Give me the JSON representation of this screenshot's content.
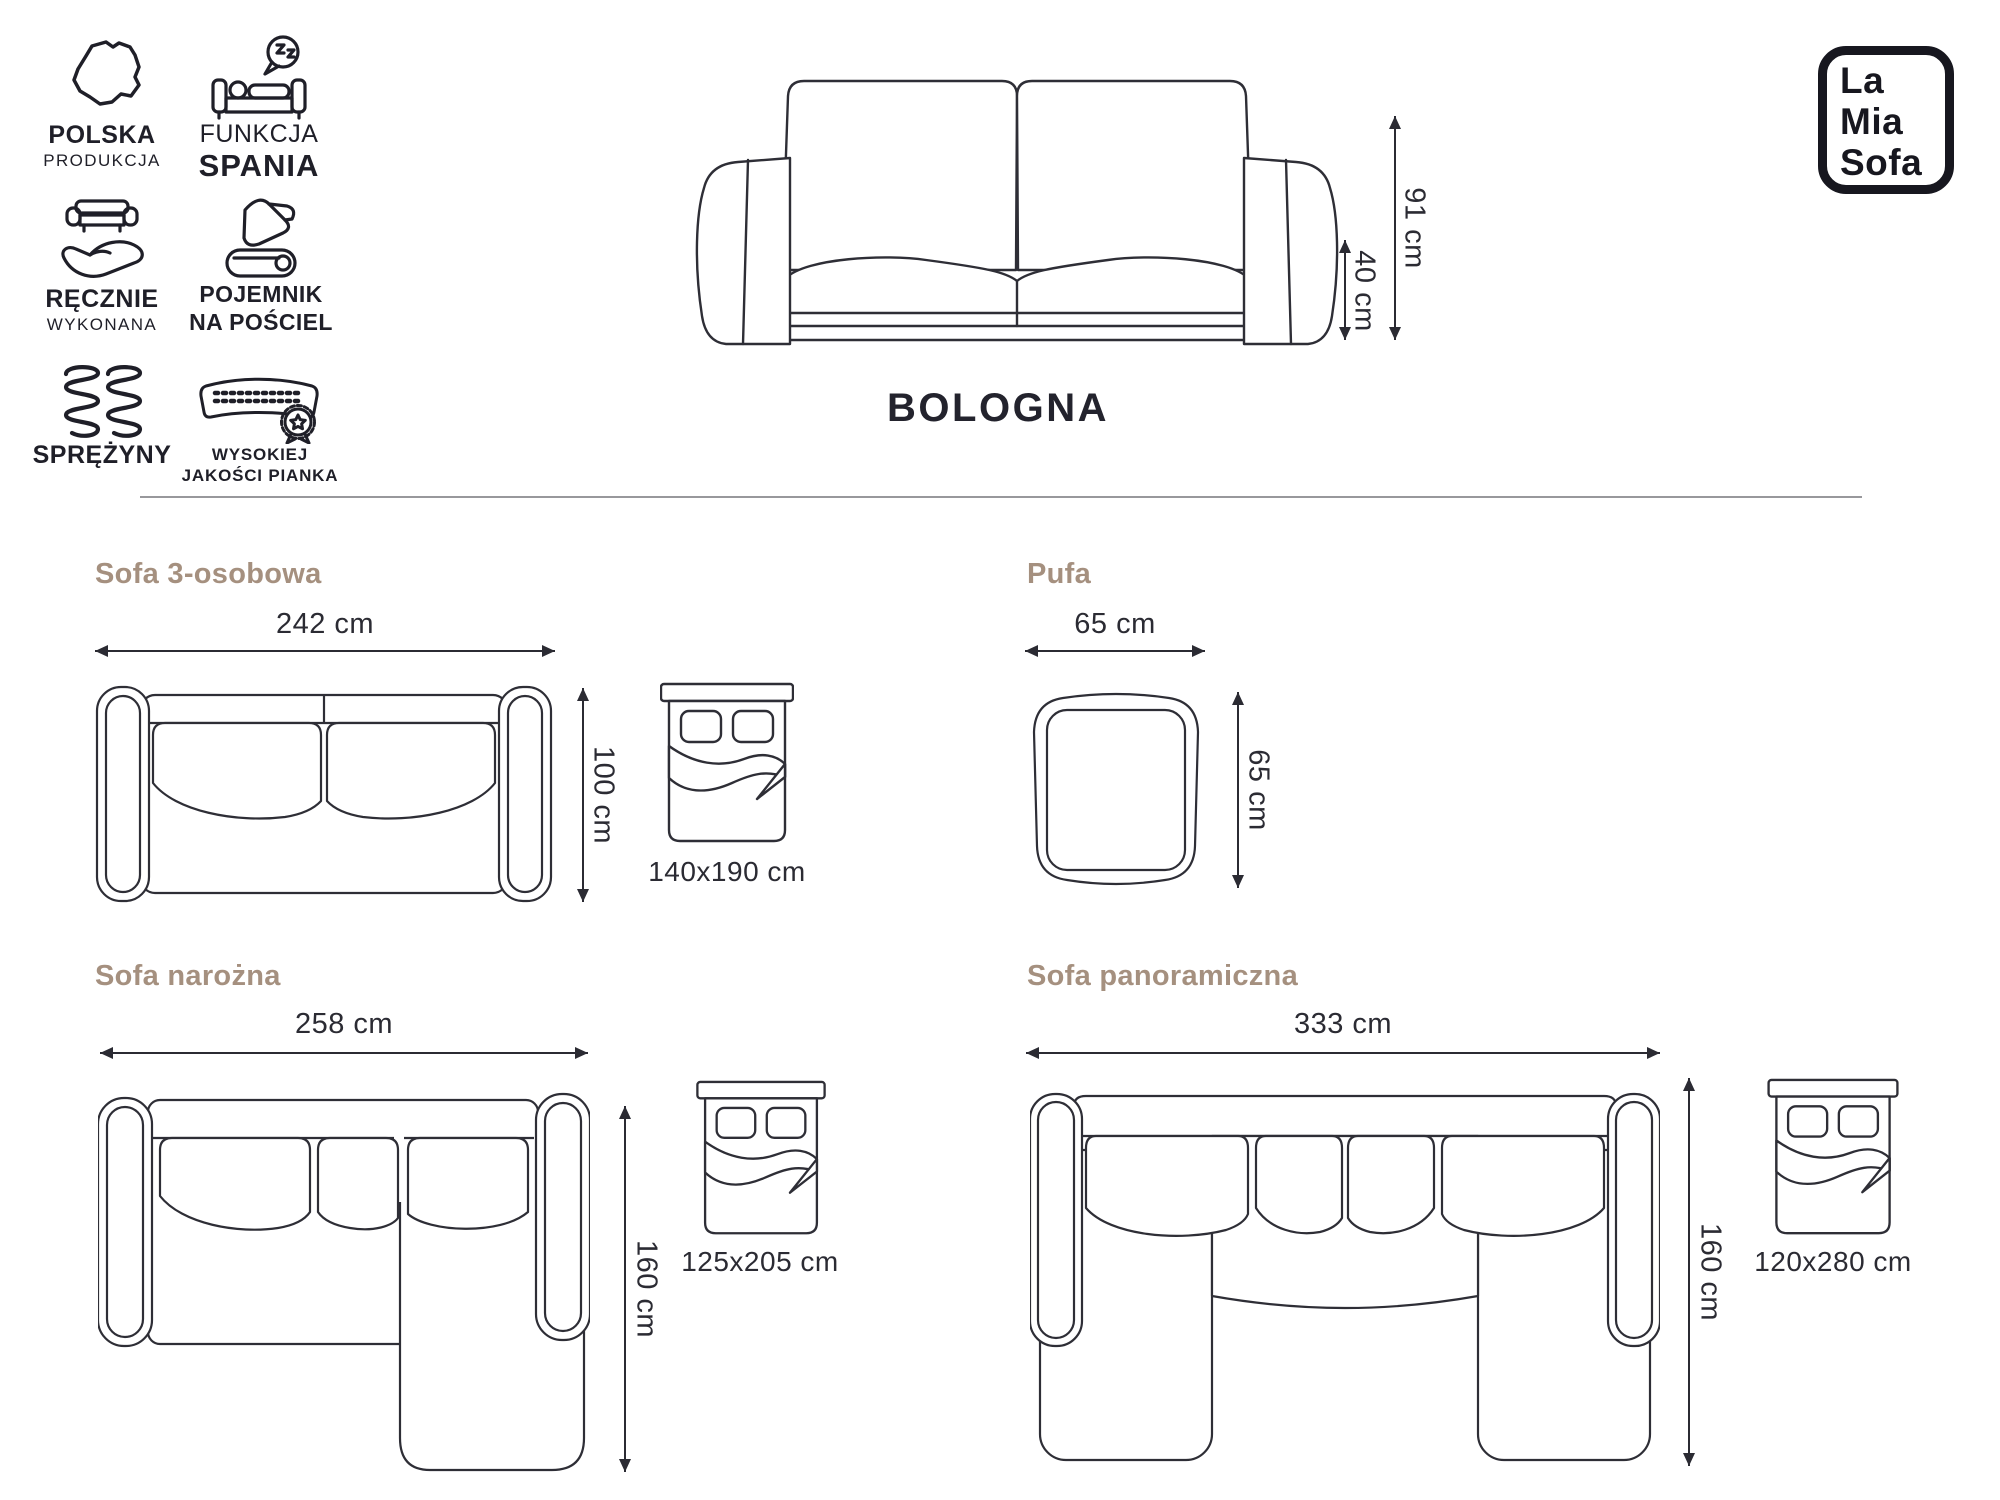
{
  "product": {
    "name": "BOLOGNA"
  },
  "logo": {
    "line1": "La",
    "line2": "Mia",
    "line3": "Sofa"
  },
  "badges": [
    {
      "icon": "poland-map-icon",
      "line1": "POLSKA",
      "line2": "PRODUKCJA"
    },
    {
      "icon": "sleep-function-icon",
      "line1": "FUNKCJA",
      "line2": "SPANIA"
    },
    {
      "icon": "handmade-icon",
      "line1": "RĘCZNIE",
      "line2": "WYKONANA"
    },
    {
      "icon": "bedding-container-icon",
      "line1": "POJEMNIK",
      "line2": "NA POŚCIEL"
    },
    {
      "icon": "springs-icon",
      "line1": "SPRĘŻYNY",
      "line2": ""
    },
    {
      "icon": "foam-icon",
      "line1": "WYSOKIEJ",
      "line2": "JAKOŚCI PIANKA"
    }
  ],
  "front_view": {
    "height_total": "91 cm",
    "height_seat": "40 cm"
  },
  "sections": {
    "sofa3": {
      "title": "Sofa 3-osobowa",
      "width": "242 cm",
      "depth": "100 cm",
      "bed": "140x190 cm"
    },
    "pufa": {
      "title": "Pufa",
      "width": "65 cm",
      "depth": "65 cm"
    },
    "narozna": {
      "title": "Sofa narożna",
      "width": "258 cm",
      "depth": "160 cm",
      "bed": "125x205 cm"
    },
    "panoramiczna": {
      "title": "Sofa panoramiczna",
      "width": "333 cm",
      "depth": "160 cm",
      "bed": "120x280 cm"
    }
  },
  "colors": {
    "line_art": "#2e2e36",
    "text": "#2b2b33",
    "section_title": "#a5907f",
    "brand": "#17171f",
    "divider": "#98989c",
    "background": "#ffffff"
  }
}
